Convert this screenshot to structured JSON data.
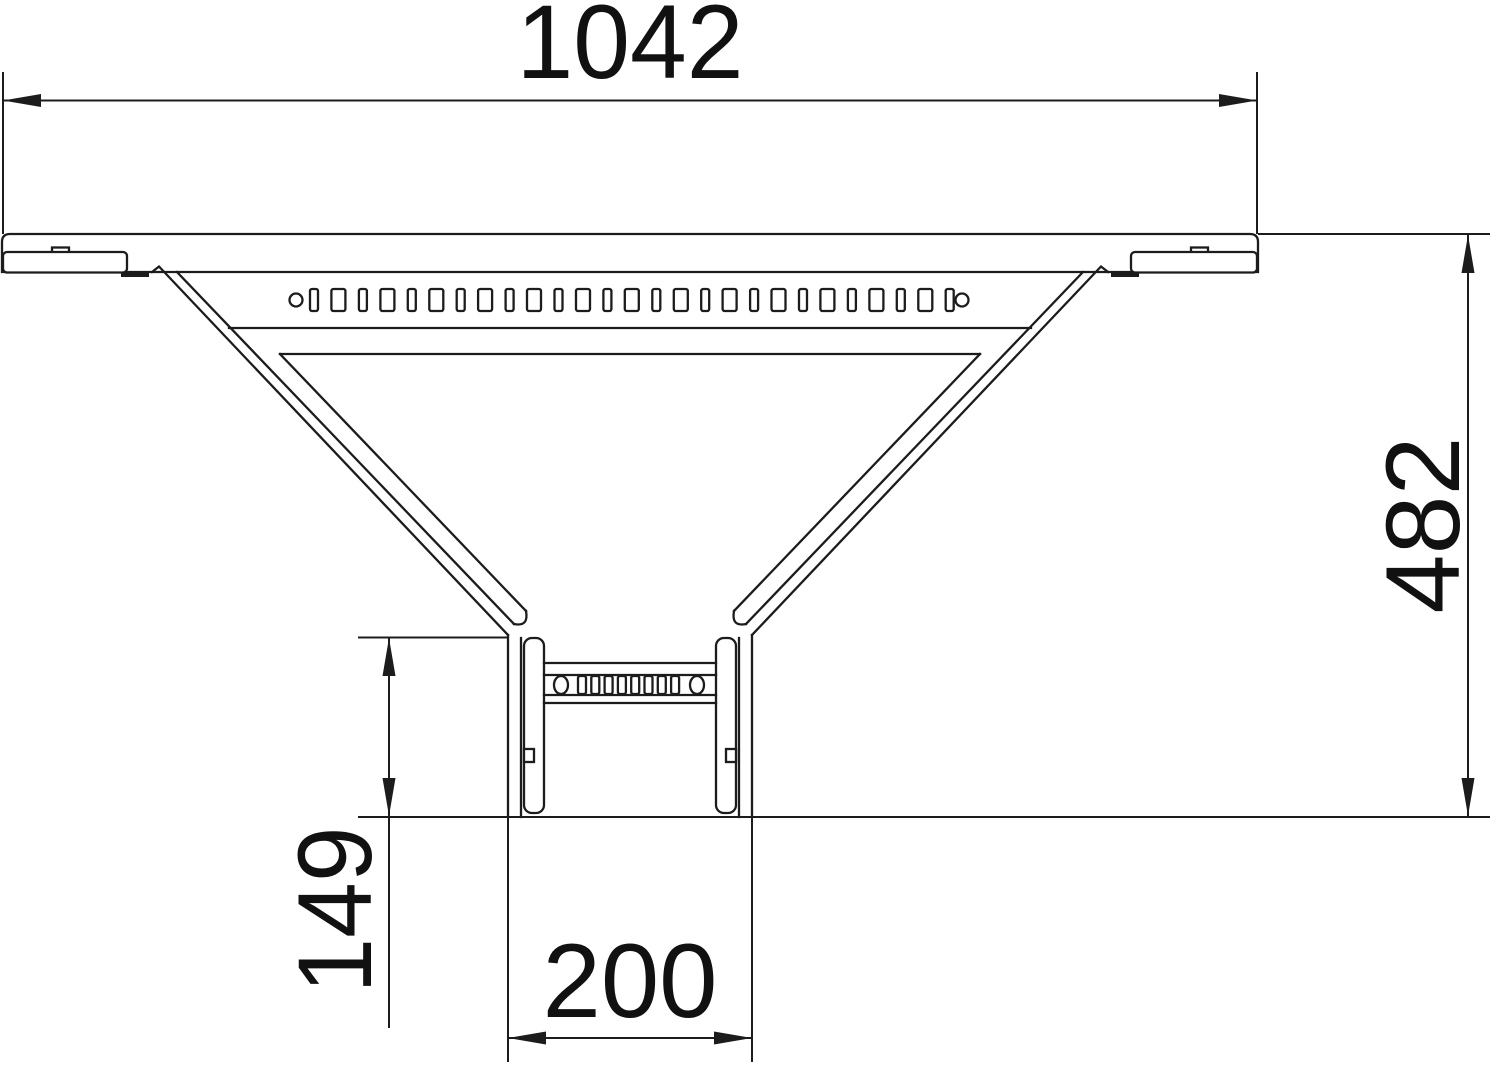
{
  "drawing": {
    "title": "cable-ladder add-on tee dimensional drawing",
    "background_color": "#ffffff",
    "line_color": "#1c1c1c",
    "dimensions": {
      "overall_width": {
        "value": "1042"
      },
      "overall_height": {
        "value": "482"
      },
      "rail_length": {
        "value": "149"
      },
      "branch_width": {
        "value": "200"
      }
    },
    "perforations": {
      "top_row": {
        "slot_count": 27,
        "start_center_x": 314,
        "pitch": 24.45,
        "narrow_width": 8,
        "wide_width": 14,
        "y": 289,
        "height": 22,
        "corner_radius": 2,
        "circle_centers_x": [
          296,
          962
        ],
        "circle_cy": 300,
        "circle_r": 6.5
      },
      "rung_row": {
        "slot_count": 8,
        "start_x": 578,
        "pitch": 13.3,
        "width": 8,
        "y": 676,
        "height": 18,
        "corner_radius": 2
      }
    }
  }
}
